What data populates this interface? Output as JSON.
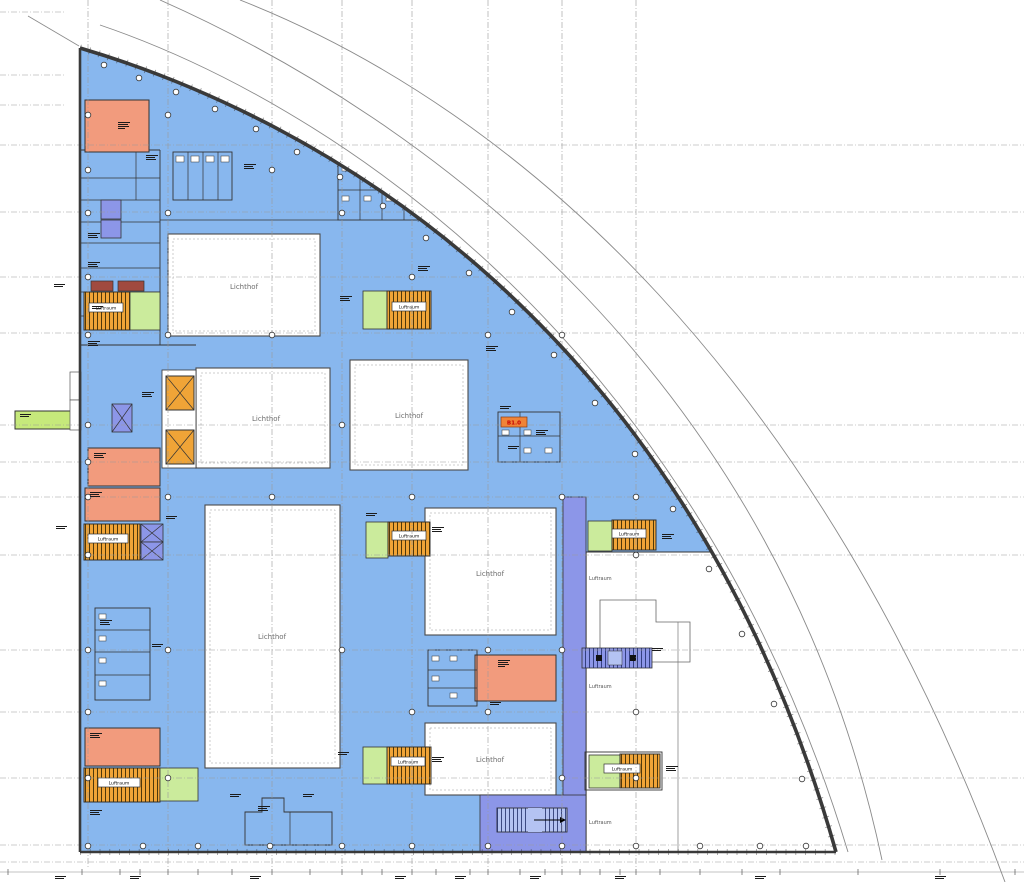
{
  "labels": {
    "lichthof": "Lichthof",
    "luftraum": "Luftraum",
    "room_tag": "B1.0"
  },
  "courtyards": [
    {
      "label": "Lichthof"
    },
    {
      "label": "Lichthof"
    },
    {
      "label": "Lichthof"
    },
    {
      "label": "Lichthof"
    },
    {
      "label": "Lichthof"
    },
    {
      "label": "Lichthof"
    }
  ],
  "stair_cores": [
    {
      "label": "Luftraum"
    },
    {
      "label": "Luftraum"
    },
    {
      "label": "Luftraum"
    },
    {
      "label": "Luftraum"
    },
    {
      "label": "Luftraum"
    },
    {
      "label": "Luftraum"
    },
    {
      "label": "Luftraum"
    },
    {
      "label": "Luftraum"
    }
  ],
  "voids": [
    {
      "label": "Luftraum"
    },
    {
      "label": "Luftraum"
    },
    {
      "label": "Luftraum"
    }
  ],
  "highlight": {
    "tag": "B1.0"
  },
  "colors": {
    "floor": "#88B7EE",
    "corridor": "#8C96E8",
    "technical": "#F29B7D",
    "stair": "#F0A437",
    "green": "#CBEB9C",
    "access": "#C6E97B",
    "shaft": "#A04A3F",
    "outline": "#333333",
    "grid": "#9A9A9A",
    "courtyard_border": "#4A4A4A",
    "tag_bg": "#F08438",
    "tag_text": "#C40000",
    "label_text": "#6E6E6E"
  }
}
